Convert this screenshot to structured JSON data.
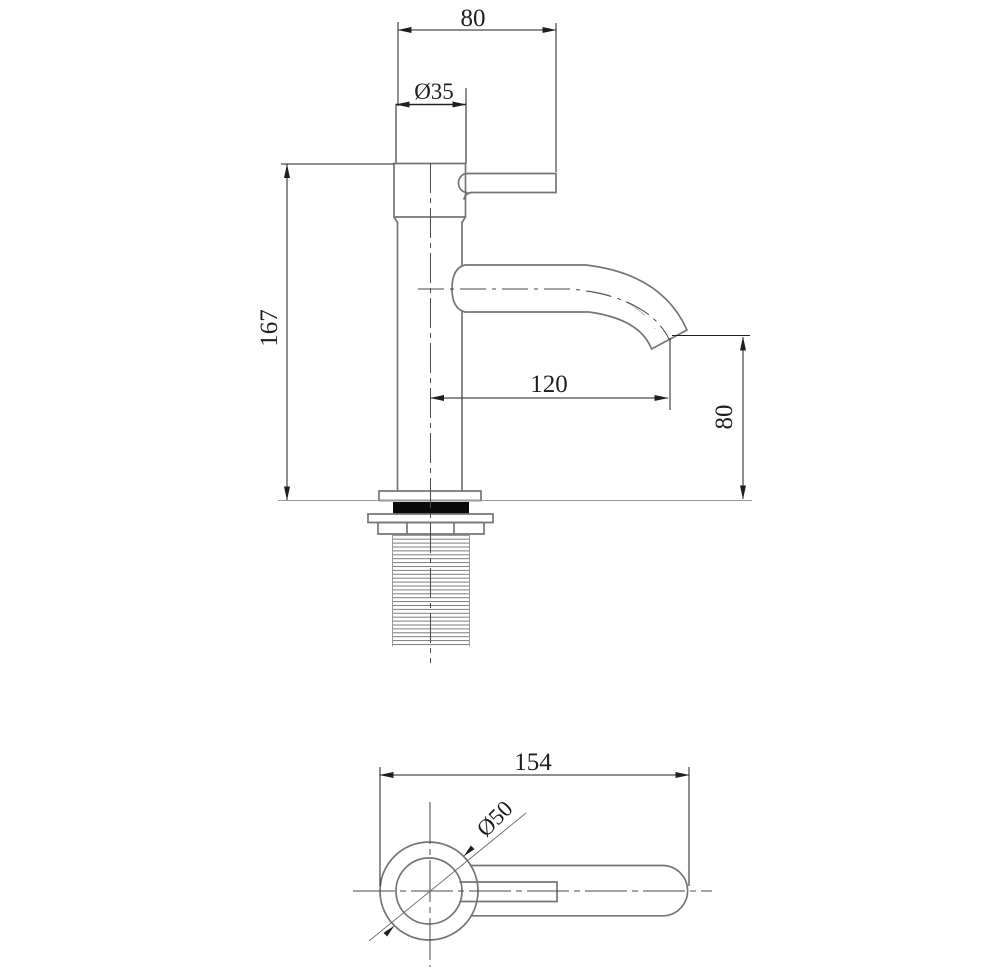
{
  "drawing": {
    "type": "faucet technical drawing, two orthographic views",
    "views": {
      "elevation": {
        "dims": {
          "handle_length": "80",
          "cap_diameter": "Ø35",
          "total_height": "167",
          "spout_reach": "120",
          "spout_height": "80"
        }
      },
      "plan": {
        "dims": {
          "overall_length": "154",
          "base_diameter": "Ø50"
        }
      }
    },
    "colors": {
      "background": "#ffffff",
      "object_line": "#757575",
      "dimension_line": "#1f1f1f",
      "seal_fill": "#0a0a0a"
    }
  }
}
